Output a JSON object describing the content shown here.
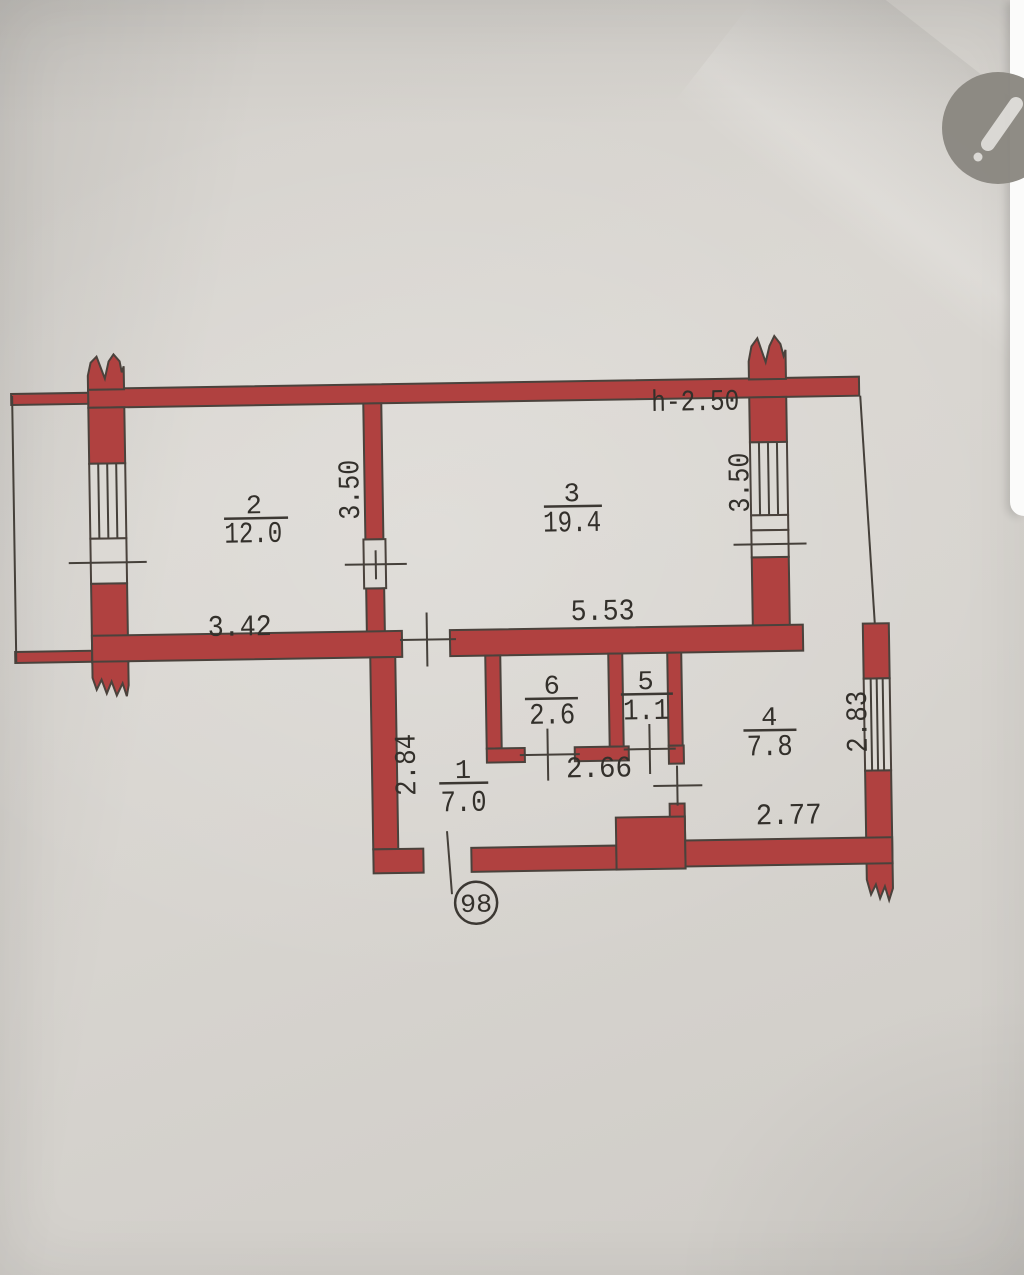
{
  "photo": {
    "paper_color": "#d8d5d0",
    "wall_color": "#b04140",
    "ink_color": "#45403a",
    "side_panel_color": "#fbfbfa",
    "edit_button_color": "#8b8881"
  },
  "plan": {
    "ceiling_height": "h-2.50",
    "apartment_number": "98",
    "rooms": {
      "room1": {
        "number": "1",
        "area": "7.0"
      },
      "room2": {
        "number": "2",
        "area": "12.0"
      },
      "room3": {
        "number": "3",
        "area": "19.4"
      },
      "room4": {
        "number": "4",
        "area": "7.8"
      },
      "room5": {
        "number": "5",
        "area": "1.1"
      },
      "room6": {
        "number": "6",
        "area": "2.6"
      }
    },
    "dimensions": {
      "room2_width": "3.42",
      "room3_width": "5.53",
      "room2_window": "3.50",
      "room3_window": "3.50",
      "hallway_depth": "2.84",
      "room4_window": "2.83",
      "inner_width": "2.66",
      "room4_width": "2.77"
    }
  },
  "viewer": {
    "edit_icon": "pencil-icon"
  }
}
